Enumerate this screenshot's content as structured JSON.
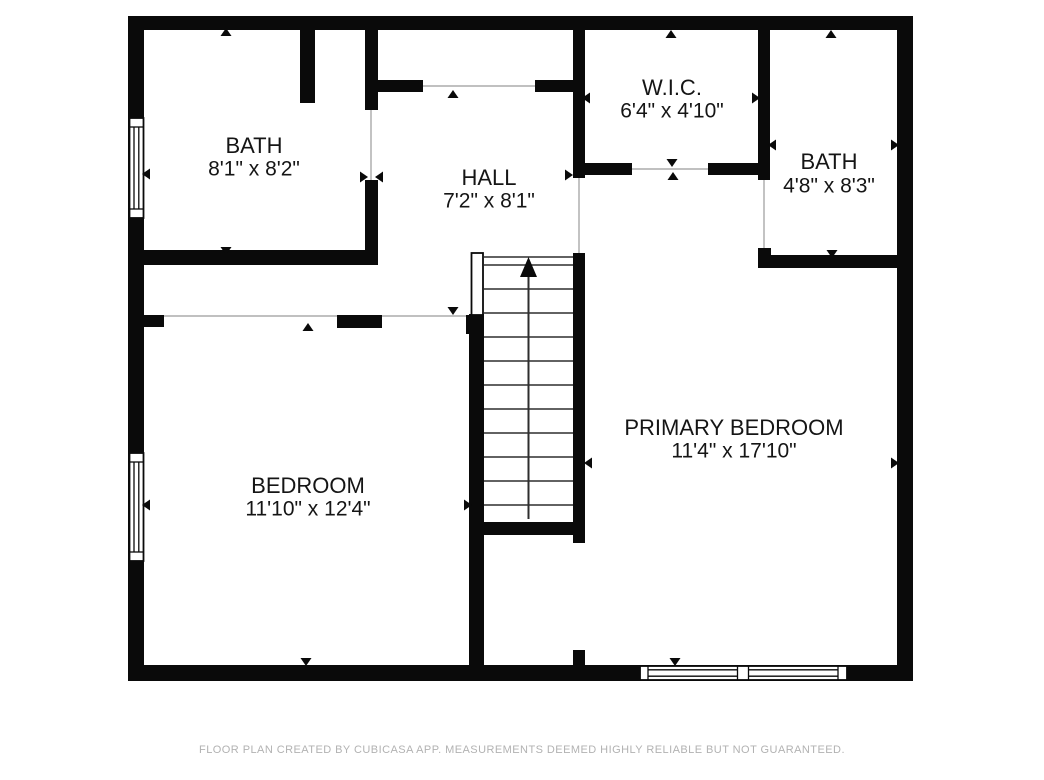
{
  "footer": {
    "disclaimer": "FLOOR PLAN CREATED BY CUBICASA APP. MEASUREMENTS DEEMED HIGHLY RELIABLE BUT NOT GUARANTEED."
  },
  "colors": {
    "wall": "#0a0a0a",
    "thin_line": "#9b9b9b",
    "stair_line": "#2e2e2e",
    "label": "#151515",
    "footer_text": "#b2b2b2",
    "background": "#ffffff"
  },
  "rooms": [
    {
      "id": "bath-1",
      "name": "BATH",
      "dims": "8'1\" x 8'2\"",
      "cx": 254,
      "name_cy": 145,
      "dims_cy": 168
    },
    {
      "id": "hall",
      "name": "HALL",
      "dims": "7'2\" x 8'1\"",
      "cx": 489,
      "name_cy": 177,
      "dims_cy": 200
    },
    {
      "id": "wic",
      "name": "W.I.C.",
      "dims": "6'4\" x 4'10\"",
      "cx": 672,
      "name_cy": 87,
      "dims_cy": 110
    },
    {
      "id": "bath-2",
      "name": "BATH",
      "dims": "4'8\" x 8'3\"",
      "cx": 829,
      "name_cy": 161,
      "dims_cy": 185
    },
    {
      "id": "bedroom",
      "name": "BEDROOM",
      "dims": "11'10\" x 12'4\"",
      "cx": 308,
      "name_cy": 485,
      "dims_cy": 508
    },
    {
      "id": "primary-bedroom",
      "name": "PRIMARY BEDROOM",
      "dims": "11'4\" x 17'10\"",
      "cx": 734,
      "name_cy": 427,
      "dims_cy": 450
    }
  ],
  "plan": {
    "walls": [
      {
        "n": "outer-wall-top",
        "r": [
          128,
          16,
          785,
          14
        ]
      },
      {
        "n": "outer-wall-left",
        "r": [
          128,
          16,
          16,
          665
        ]
      },
      {
        "n": "outer-wall-right",
        "r": [
          897,
          16,
          16,
          665
        ]
      },
      {
        "n": "outer-wall-bottom",
        "r": [
          128,
          665,
          785,
          16
        ]
      },
      {
        "n": "top-closet-stub",
        "r": [
          300,
          16,
          15,
          87
        ]
      },
      {
        "n": "bath1-hall-wall-upper",
        "r": [
          365,
          16,
          13,
          94
        ]
      },
      {
        "n": "bath1-hall-wall-lower",
        "r": [
          365,
          180,
          13,
          85
        ]
      },
      {
        "n": "bath1-bottom-wall",
        "r": [
          144,
          250,
          234,
          15
        ]
      },
      {
        "n": "hall-top-wall-left",
        "r": [
          378,
          80,
          45,
          12
        ]
      },
      {
        "n": "hall-top-wall-right",
        "r": [
          535,
          80,
          38,
          12
        ]
      },
      {
        "n": "wic-left-wall",
        "r": [
          573,
          16,
          12,
          162
        ]
      },
      {
        "n": "wic-bottom-wall-left",
        "r": [
          573,
          163,
          59,
          12
        ]
      },
      {
        "n": "wic-bottom-wall-right",
        "r": [
          708,
          163,
          62,
          12
        ]
      },
      {
        "n": "wic-bath2-divider-wall",
        "r": [
          758,
          16,
          12,
          164
        ]
      },
      {
        "n": "bath2-bottom-stub",
        "r": [
          758,
          248,
          13,
          20
        ]
      },
      {
        "n": "bath2-bottom-wall",
        "r": [
          758,
          255,
          139,
          13
        ]
      },
      {
        "n": "bedroom-top-stub",
        "r": [
          144,
          315,
          20,
          12
        ]
      },
      {
        "n": "bedroom-top-wall",
        "r": [
          337,
          315,
          45,
          13
        ]
      },
      {
        "n": "stairs-newel-foot",
        "r": [
          466,
          315,
          18,
          19
        ]
      },
      {
        "n": "stairs-left-wall",
        "r": [
          469,
          314,
          15,
          367
        ]
      },
      {
        "n": "stairs-right-wall",
        "r": [
          573,
          253,
          12,
          290
        ]
      },
      {
        "n": "stairs-bottom-wall",
        "r": [
          478,
          522,
          107,
          13
        ]
      },
      {
        "n": "understair-stub",
        "r": [
          573,
          650,
          12,
          31
        ]
      }
    ],
    "thin_lines": [
      [
        164,
        316,
        337,
        316
      ],
      [
        382,
        316,
        466,
        316
      ],
      [
        423,
        86,
        535,
        86
      ],
      [
        632,
        169,
        708,
        169
      ],
      [
        579,
        178,
        579,
        253
      ],
      [
        764,
        180,
        764,
        250
      ],
      [
        371,
        110,
        371,
        180
      ]
    ],
    "windows": [
      {
        "n": "window-left-upper",
        "rect": [
          129.5,
          118,
          14,
          100
        ],
        "lines": [
          [
            129.5,
            127,
            143.5,
            127
          ],
          [
            129.5,
            209,
            143.5,
            209
          ],
          [
            134,
            127,
            134,
            209
          ],
          [
            138.8,
            127,
            138.8,
            209
          ]
        ]
      },
      {
        "n": "window-left-lower",
        "rect": [
          129.5,
          453,
          14,
          108
        ],
        "lines": [
          [
            129.5,
            462,
            143.5,
            462
          ],
          [
            129.5,
            552,
            143.5,
            552
          ],
          [
            134,
            462,
            134,
            552
          ],
          [
            138.8,
            462,
            138.8,
            552
          ]
        ]
      },
      {
        "n": "window-bottom",
        "rect": [
          640,
          666,
          207,
          14
        ],
        "lines": [
          [
            648,
            666,
            648,
            680
          ],
          [
            838,
            666,
            838,
            680
          ],
          [
            737.5,
            666,
            737.5,
            680
          ],
          [
            748.5,
            666,
            748.5,
            680
          ],
          [
            648,
            669.8,
            737.5,
            669.8
          ],
          [
            748.5,
            669.8,
            838,
            669.8
          ],
          [
            648,
            676.2,
            737.5,
            676.2
          ],
          [
            748.5,
            676.2,
            838,
            676.2
          ]
        ]
      },
      {
        "n": "stairs-newel-post",
        "rect": [
          471.5,
          253,
          11.5,
          62
        ],
        "lines": []
      }
    ],
    "stairs": {
      "tread_x": [
        484,
        573
      ],
      "tread_ys": [
        265,
        289,
        313,
        337,
        361,
        385,
        409,
        433,
        457,
        481,
        505
      ],
      "top_line": [
        484,
        257,
        573,
        257
      ],
      "arrow": {
        "stem": [
          528.5,
          275,
          528.5,
          519
        ],
        "head": [
          [
            520,
            277
          ],
          [
            537,
            277
          ],
          [
            528.5,
            257
          ]
        ]
      }
    },
    "markers": [
      {
        "a": [
          226,
          28
        ],
        "d": "up"
      },
      {
        "a": [
          226,
          255
        ],
        "d": "down"
      },
      {
        "a": [
          142,
          174
        ],
        "d": "left"
      },
      {
        "a": [
          368,
          177
        ],
        "d": "right"
      },
      {
        "a": [
          375,
          177
        ],
        "d": "left"
      },
      {
        "a": [
          453,
          90
        ],
        "d": "up"
      },
      {
        "a": [
          573,
          175
        ],
        "d": "right"
      },
      {
        "a": [
          453,
          315
        ],
        "d": "down"
      },
      {
        "a": [
          671,
          30
        ],
        "d": "up"
      },
      {
        "a": [
          582,
          98
        ],
        "d": "left"
      },
      {
        "a": [
          760,
          98
        ],
        "d": "right"
      },
      {
        "a": [
          672,
          167
        ],
        "d": "down"
      },
      {
        "a": [
          673,
          172
        ],
        "d": "up"
      },
      {
        "a": [
          831,
          30
        ],
        "d": "up"
      },
      {
        "a": [
          768,
          145
        ],
        "d": "left"
      },
      {
        "a": [
          899,
          145
        ],
        "d": "right"
      },
      {
        "a": [
          832,
          258
        ],
        "d": "down"
      },
      {
        "a": [
          308,
          323
        ],
        "d": "up"
      },
      {
        "a": [
          142,
          505
        ],
        "d": "left"
      },
      {
        "a": [
          472,
          505
        ],
        "d": "right"
      },
      {
        "a": [
          306,
          666
        ],
        "d": "down"
      },
      {
        "a": [
          584,
          463
        ],
        "d": "left"
      },
      {
        "a": [
          899,
          463
        ],
        "d": "right"
      },
      {
        "a": [
          675,
          666
        ],
        "d": "down"
      }
    ]
  }
}
